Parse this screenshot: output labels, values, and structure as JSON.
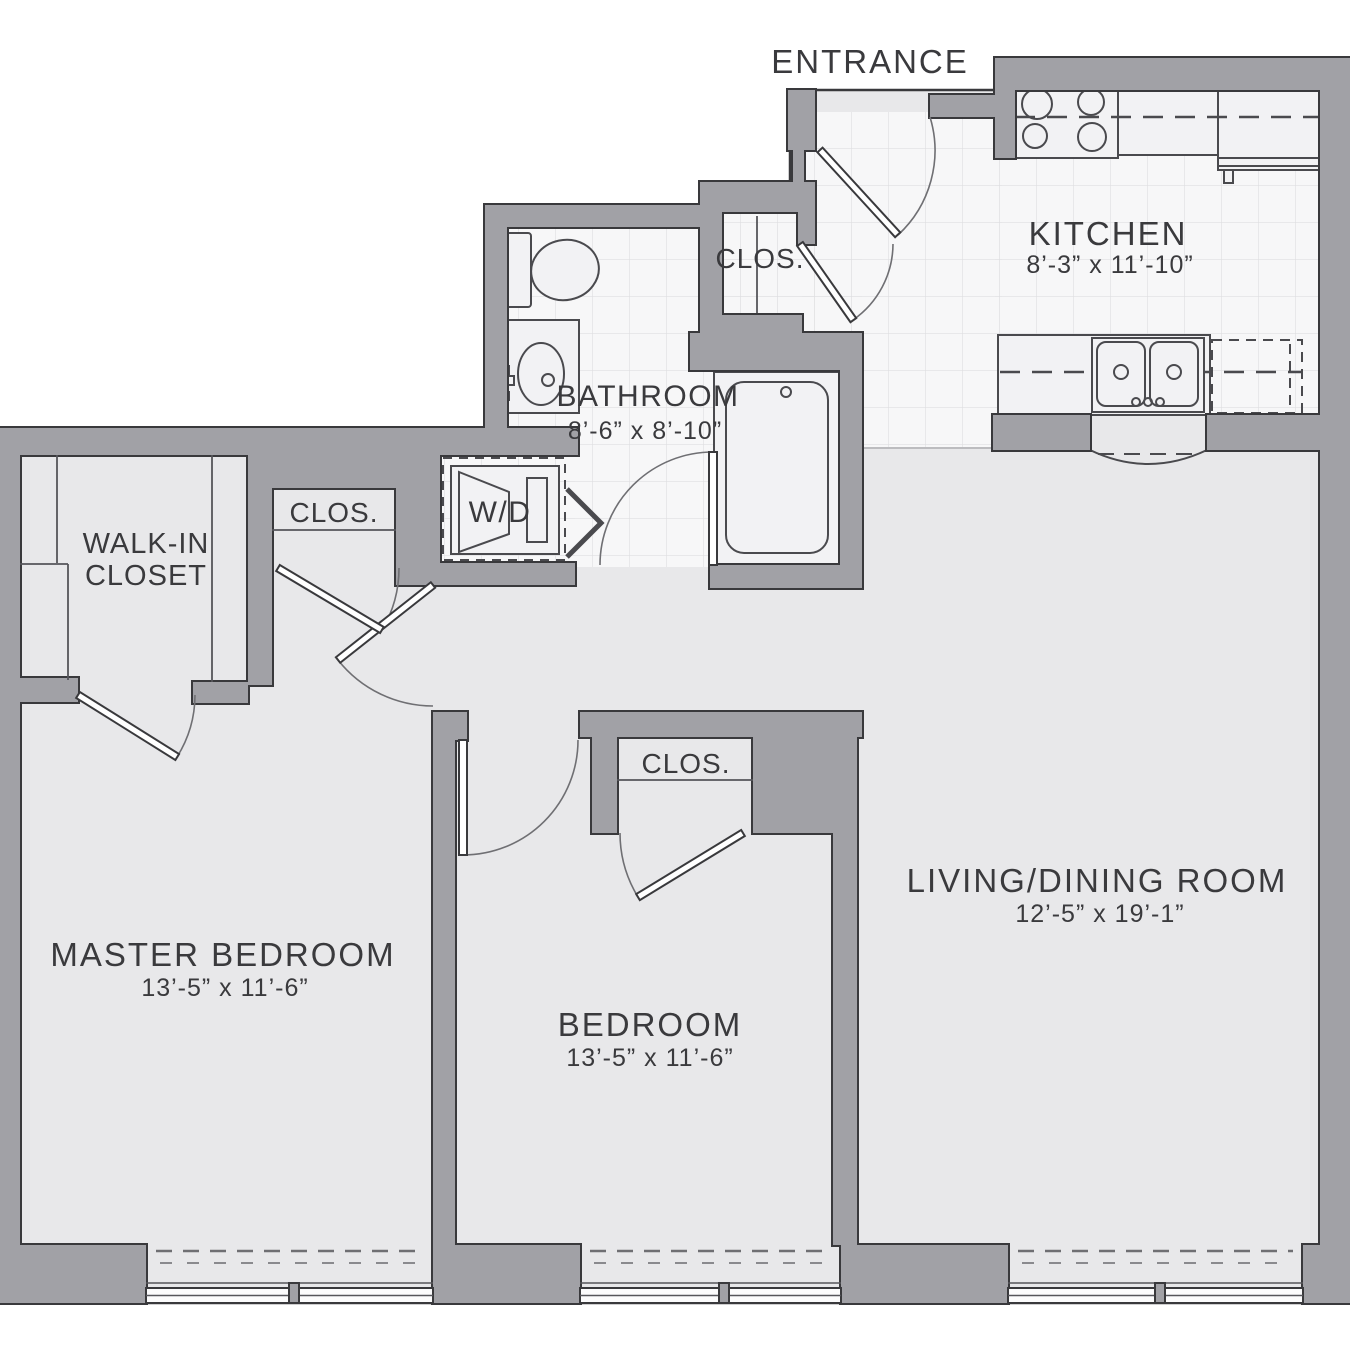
{
  "title": "Two Bedroom Apartment Floor Plan",
  "colors": {
    "wall": "#a1a1a6",
    "wall_outline": "#39393c",
    "floor": "#e8e8ea",
    "tile": "#f7f7f8",
    "tile_line": "#dedee1",
    "fixture": "#f2f2f4",
    "fixture_outline": "#4a4a4e",
    "arc": "#6f6f73",
    "dash": "#6f6f73",
    "text": "#3a3a3d",
    "window_glass": "#fbfbfc"
  },
  "rooms": {
    "entrance": {
      "label": "ENTRANCE"
    },
    "kitchen": {
      "label": "KITCHEN",
      "dims": "8’-3” x 11’-10”"
    },
    "bathroom": {
      "label": "BATHROOM",
      "dims": "8’-6” x 8’-10”"
    },
    "entry_closet": {
      "label": "CLOS."
    },
    "hall_closet": {
      "label": "CLOS."
    },
    "bedroom_closet": {
      "label": "CLOS."
    },
    "walk_in_closet": {
      "label_line1": "WALK-IN",
      "label_line2": "CLOSET"
    },
    "washer_dryer": {
      "label": "W/D"
    },
    "master_bedroom": {
      "label": "MASTER BEDROOM",
      "dims": "13’-5” x 11’-6”"
    },
    "bedroom": {
      "label": "BEDROOM",
      "dims": "13’-5” x 11’-6”"
    },
    "living_dining": {
      "label": "LIVING/DINING ROOM",
      "dims": "12’-5” x 19’-1”"
    }
  }
}
